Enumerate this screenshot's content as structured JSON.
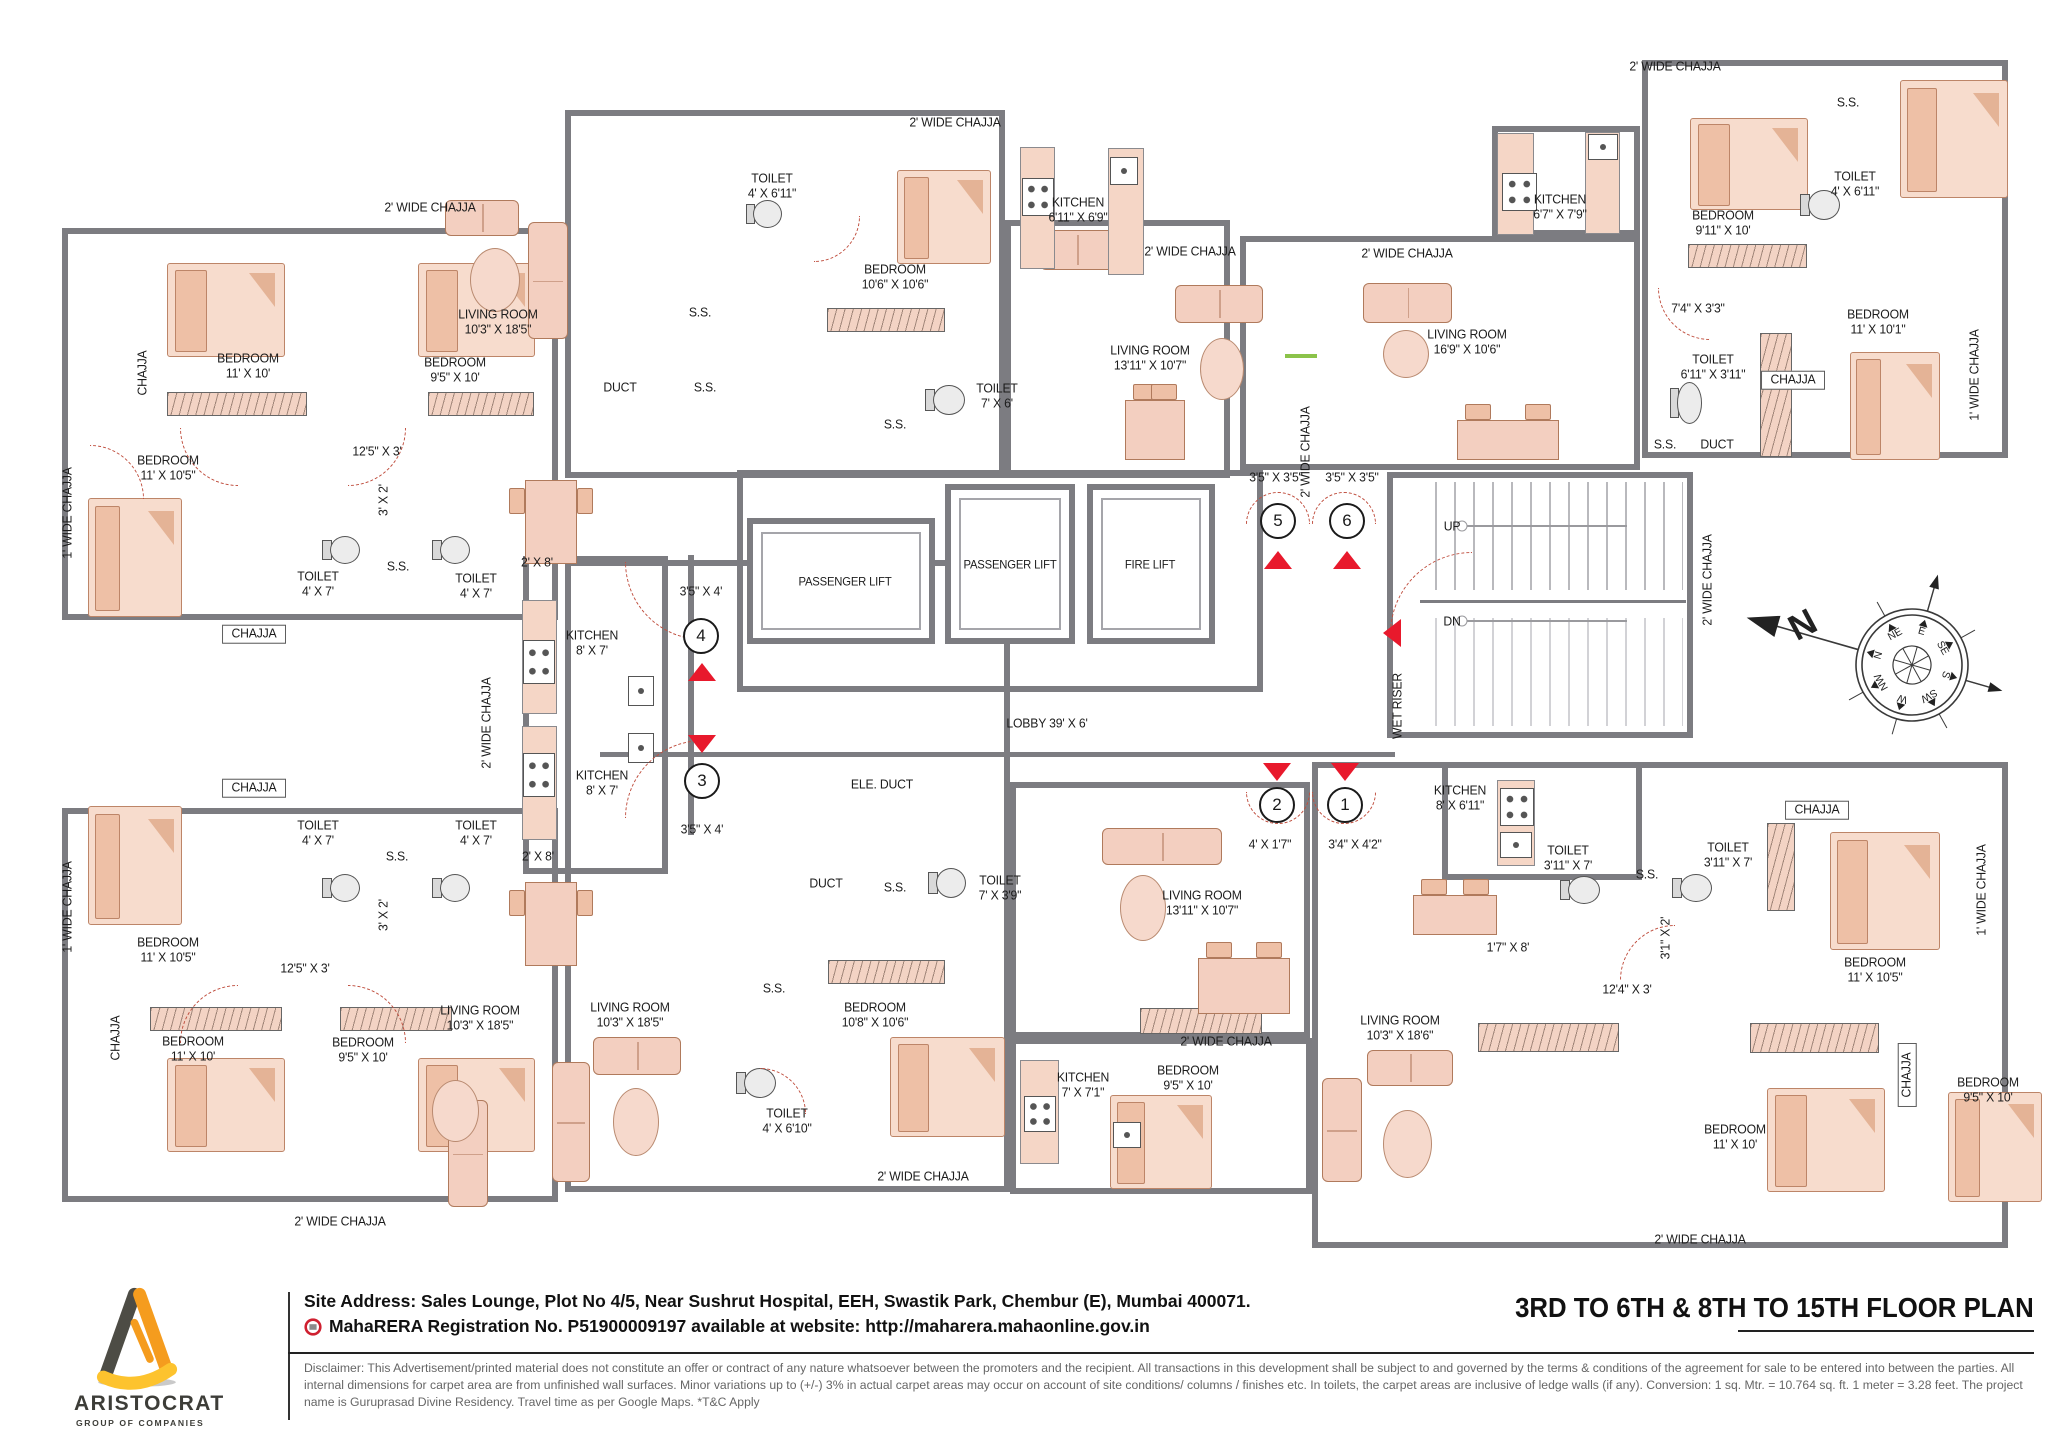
{
  "title_block": {
    "text": "3RD TO 6TH &  8TH TO 15TH FLOOR PLAN"
  },
  "footer": {
    "logo_name": "ARISTOCRAT",
    "logo_tagline": "GROUP OF COMPANIES",
    "site_address": "Site Address: Sales Lounge, Plot No 4/5, Near Sushrut Hospital, EEH, Swastik Park, Chembur (E), Mumbai 400071.",
    "rera_line": "MahaRERA Registration No. P51900009197 available at website: http://maharera.mahaonline.gov.in",
    "disclaimer": "Disclaimer: This Advertisement/printed material does not constitute an offer or contract of any nature whatsoever between the promoters and the recip­ient. All transactions in this development shall be subject to and governed by the terms & conditions of the agreement for sale to be entered into between the parties. All internal dimensions for carpet area are from unfinished wall surfaces. Minor variations up to (+/-) 3% in actual carpet areas may occur on account of site conditions/ columns / finishes etc. In toilets, the carpet areas are inclusive of ledge walls (if any). Conversion: 1 sq. Mtr. = 10.764 sq. ft. 1 meter = 3.28 feet. The project name is Guruprasad Divine Residency. Travel time as per Google Maps. *T&C Apply"
  },
  "plan": {
    "compass": {
      "points": [
        "N",
        "NE",
        "E",
        "SE",
        "S",
        "SW",
        "W",
        "NW"
      ],
      "big_n": "N"
    },
    "flat_markers": [
      {
        "n": "4",
        "x": 701,
        "y": 636
      },
      {
        "n": "3",
        "x": 702,
        "y": 781
      },
      {
        "n": "5",
        "x": 1278,
        "y": 521
      },
      {
        "n": "6",
        "x": 1347,
        "y": 521
      },
      {
        "n": "2",
        "x": 1277,
        "y": 805
      },
      {
        "n": "1",
        "x": 1345,
        "y": 805
      }
    ],
    "entry_arrows": [
      {
        "x": 702,
        "y": 672,
        "dir": "up"
      },
      {
        "x": 702,
        "y": 744,
        "dir": "down"
      },
      {
        "x": 1278,
        "y": 560,
        "dir": "up"
      },
      {
        "x": 1347,
        "y": 560,
        "dir": "up"
      },
      {
        "x": 1277,
        "y": 772,
        "dir": "down"
      },
      {
        "x": 1345,
        "y": 772,
        "dir": "down"
      },
      {
        "x": 1392,
        "y": 633,
        "dir": "left"
      }
    ],
    "labels": [
      {
        "t": "2' WIDE CHAJJA",
        "x": 430,
        "y": 208
      },
      {
        "t": "BEDROOM",
        "d": "11' X 10'",
        "x": 248,
        "y": 366
      },
      {
        "t": "BEDROOM",
        "d": "9'5\" X 10'",
        "x": 455,
        "y": 370
      },
      {
        "t": "CHAJJA",
        "x": 143,
        "y": 373,
        "r": 1
      },
      {
        "t": "BEDROOM",
        "d": "11' X 10'5\"",
        "x": 168,
        "y": 468
      },
      {
        "t": "1' WIDE CHAJJA",
        "x": 68,
        "y": 513,
        "r": 1
      },
      {
        "t": "LIVING ROOM",
        "d": "10'3\" X 18'5\"",
        "x": 498,
        "y": 322
      },
      {
        "t": "12'5\" X 3'",
        "x": 377,
        "y": 452
      },
      {
        "t": "3' X 2'",
        "x": 384,
        "y": 500,
        "r": 1
      },
      {
        "t": "TOILET",
        "d": "4' X 7'",
        "x": 318,
        "y": 584
      },
      {
        "t": "TOILET",
        "d": "4' X 7'",
        "x": 476,
        "y": 586
      },
      {
        "t": "S.S.",
        "x": 398,
        "y": 567
      },
      {
        "t": "2' X 8'",
        "x": 537,
        "y": 563
      },
      {
        "t": "KITCHEN",
        "d": "8' X 7'",
        "x": 592,
        "y": 643
      },
      {
        "t": "3'5\" X 4'",
        "x": 701,
        "y": 592
      },
      {
        "t": "CHAJJA",
        "x": 254,
        "y": 634,
        "box": true
      },
      {
        "t": "CHAJJA",
        "x": 254,
        "y": 788,
        "box": true
      },
      {
        "t": "KITCHEN",
        "d": "8' X 7'",
        "x": 602,
        "y": 783
      },
      {
        "t": "2' X 8'",
        "x": 538,
        "y": 857
      },
      {
        "t": "TOILET",
        "d": "4' X 7'",
        "x": 318,
        "y": 833
      },
      {
        "t": "TOILET",
        "d": "4' X 7'",
        "x": 476,
        "y": 833
      },
      {
        "t": "S.S.",
        "x": 397,
        "y": 857
      },
      {
        "t": "3' X 2'",
        "x": 384,
        "y": 915,
        "r": 1
      },
      {
        "t": "12'5\" X 3'",
        "x": 305,
        "y": 969
      },
      {
        "t": "3'5\" X 4'",
        "x": 702,
        "y": 830
      },
      {
        "t": "BEDROOM",
        "d": "11' X 10'5\"",
        "x": 168,
        "y": 950
      },
      {
        "t": "1' WIDE CHAJJA",
        "x": 68,
        "y": 907,
        "r": 1
      },
      {
        "t": "BEDROOM",
        "d": "11' X 10'",
        "x": 193,
        "y": 1049
      },
      {
        "t": "BEDROOM",
        "d": "9'5\" X 10'",
        "x": 363,
        "y": 1050
      },
      {
        "t": "CHAJJA",
        "x": 116,
        "y": 1038,
        "r": 1
      },
      {
        "t": "LIVING ROOM",
        "d": "10'3\" X 18'5\"",
        "x": 480,
        "y": 1018
      },
      {
        "t": "2' WIDE CHAJJA",
        "x": 340,
        "y": 1222
      },
      {
        "t": "2' WIDE CHAJJA",
        "x": 487,
        "y": 723,
        "r": 1
      },
      {
        "t": "2' WIDE CHAJJA",
        "x": 955,
        "y": 123
      },
      {
        "t": "TOILET",
        "d": "4' X 6'11\"",
        "x": 772,
        "y": 186
      },
      {
        "t": "BEDROOM",
        "d": "10'6\" X 10'6\"",
        "x": 895,
        "y": 277
      },
      {
        "t": "KITCHEN",
        "d": "6'11\" X 6'9\"",
        "x": 1078,
        "y": 210
      },
      {
        "t": "S.S.",
        "x": 700,
        "y": 313
      },
      {
        "t": "DUCT",
        "x": 620,
        "y": 388
      },
      {
        "t": "S.S.",
        "x": 705,
        "y": 388
      },
      {
        "t": "TOILET",
        "d": "7' X 6'",
        "x": 997,
        "y": 396
      },
      {
        "t": "S.S.",
        "x": 895,
        "y": 425
      },
      {
        "t": "LIVING ROOM",
        "d": "13'11\" X 10'7\"",
        "x": 1150,
        "y": 358
      },
      {
        "t": "2' WIDE CHAJJA",
        "x": 1190,
        "y": 252
      },
      {
        "t": "2' WIDE CHAJJA",
        "x": 1407,
        "y": 254
      },
      {
        "t": "LIVING ROOM",
        "d": "16'9\" X 10'6\"",
        "x": 1467,
        "y": 342
      },
      {
        "t": "KITCHEN",
        "d": "6'7\" X 7'9\"",
        "x": 1560,
        "y": 207
      },
      {
        "t": "2' WIDE CHAJJA",
        "x": 1675,
        "y": 67
      },
      {
        "t": "S.S.",
        "x": 1848,
        "y": 103
      },
      {
        "t": "TOILET",
        "d": "4' X 6'11\"",
        "x": 1855,
        "y": 184
      },
      {
        "t": "BEDROOM",
        "d": "9'11\" X 10'",
        "x": 1723,
        "y": 223
      },
      {
        "t": "7'4\" X 3'3\"",
        "x": 1698,
        "y": 309
      },
      {
        "t": "BEDROOM",
        "d": "11' X 10'1\"",
        "x": 1878,
        "y": 322
      },
      {
        "t": "TOILET",
        "d": "6'11\" X 3'11\"",
        "x": 1713,
        "y": 367
      },
      {
        "t": "1' WIDE CHAJJA",
        "x": 1975,
        "y": 375,
        "r": 1
      },
      {
        "t": "S.S.",
        "x": 1665,
        "y": 445
      },
      {
        "t": "DUCT",
        "x": 1717,
        "y": 445
      },
      {
        "t": "CHAJJA",
        "x": 1793,
        "y": 380,
        "box": true
      },
      {
        "t": "2' WIDE CHAJJA",
        "x": 1306,
        "y": 452,
        "r": 1
      },
      {
        "t": "3'5\" X 3'5\"",
        "x": 1276,
        "y": 478
      },
      {
        "t": "3'5\" X 3'5\"",
        "x": 1352,
        "y": 478
      },
      {
        "t": "UP",
        "x": 1452,
        "y": 527
      },
      {
        "t": "DN",
        "x": 1452,
        "y": 622
      },
      {
        "t": "2' WIDE CHAJJA",
        "x": 1708,
        "y": 580,
        "r": 1
      },
      {
        "t": "WET RISER",
        "x": 1398,
        "y": 706,
        "r": 1
      },
      {
        "t": "LOBBY 39' X 6'",
        "x": 1047,
        "y": 724
      },
      {
        "t": "ELE. DUCT",
        "x": 882,
        "y": 785
      },
      {
        "t": "DUCT",
        "x": 826,
        "y": 884
      },
      {
        "t": "S.S.",
        "x": 895,
        "y": 888
      },
      {
        "t": "TOILET",
        "d": "7' X 3'9\"",
        "x": 1000,
        "y": 888
      },
      {
        "t": "S.S.",
        "x": 774,
        "y": 989
      },
      {
        "t": "BEDROOM",
        "d": "10'8\" X 10'6\"",
        "x": 875,
        "y": 1015
      },
      {
        "t": "LIVING ROOM",
        "d": "10'3\" X 18'5\"",
        "x": 630,
        "y": 1015
      },
      {
        "t": "TOILET",
        "d": "4' X 6'10\"",
        "x": 787,
        "y": 1121
      },
      {
        "t": "2' WIDE CHAJJA",
        "x": 923,
        "y": 1177
      },
      {
        "t": "4' X 1'7\"",
        "x": 1270,
        "y": 845
      },
      {
        "t": "3'4\" X 4'2\"",
        "x": 1355,
        "y": 845
      },
      {
        "t": "LIVING ROOM",
        "d": "13'11\" X 10'7\"",
        "x": 1202,
        "y": 903
      },
      {
        "t": "KITCHEN",
        "d": "8' X 6'11\"",
        "x": 1460,
        "y": 798
      },
      {
        "t": "1'7\" X 8'",
        "x": 1508,
        "y": 948
      },
      {
        "t": "KITCHEN",
        "d": "7' X 7'1\"",
        "x": 1083,
        "y": 1085
      },
      {
        "t": "LIVING ROOM",
        "d": "10'3\" X 18'6\"",
        "x": 1400,
        "y": 1028
      },
      {
        "t": "2' WIDE CHAJJA",
        "x": 1226,
        "y": 1042
      },
      {
        "t": "BEDROOM",
        "d": "9'5\" X 10'",
        "x": 1188,
        "y": 1078
      },
      {
        "t": "TOILET",
        "d": "3'11\" X 7'",
        "x": 1568,
        "y": 858
      },
      {
        "t": "TOILET",
        "d": "3'11\" X 7'",
        "x": 1728,
        "y": 855
      },
      {
        "t": "S.S.",
        "x": 1647,
        "y": 875
      },
      {
        "t": "3'1\" X 2'",
        "x": 1666,
        "y": 938,
        "r": 1
      },
      {
        "t": "12'4\" X 3'",
        "x": 1627,
        "y": 990
      },
      {
        "t": "BEDROOM",
        "d": "11' X 10'5\"",
        "x": 1875,
        "y": 970
      },
      {
        "t": "CHAJJA",
        "x": 1817,
        "y": 810,
        "box": true
      },
      {
        "t": "1' WIDE CHAJJA",
        "x": 1982,
        "y": 890,
        "r": 1
      },
      {
        "t": "CHAJJA",
        "x": 1907,
        "y": 1075,
        "r": 1,
        "box": true
      },
      {
        "t": "BEDROOM",
        "d": "11' X 10'",
        "x": 1735,
        "y": 1137
      },
      {
        "t": "BEDROOM",
        "d": "9'5\" X 10'",
        "x": 1988,
        "y": 1090
      },
      {
        "t": "2' WIDE CHAJJA",
        "x": 1700,
        "y": 1240
      },
      {
        "t": "PASSENGER LIFT",
        "x": 845,
        "y": 582,
        "fs": 12
      },
      {
        "t": "PASSENGER LIFT",
        "x": 1010,
        "y": 565,
        "fs": 12
      },
      {
        "t": "FIRE LIFT",
        "x": 1150,
        "y": 565,
        "fs": 12
      }
    ]
  }
}
